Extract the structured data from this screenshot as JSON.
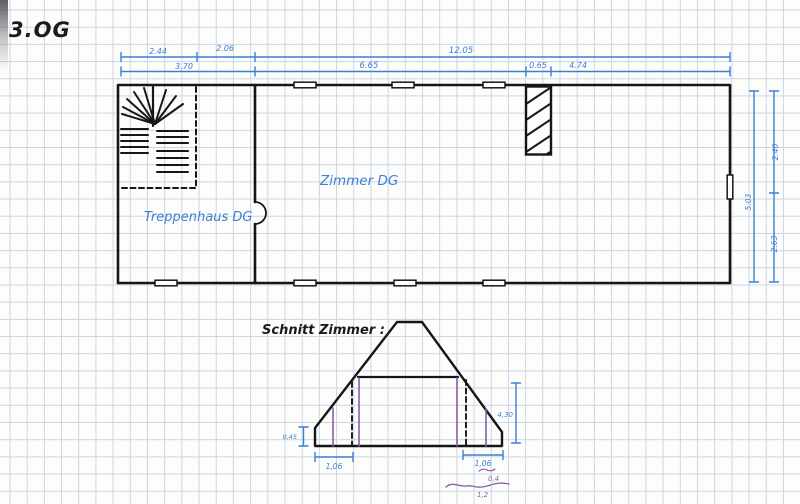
{
  "title": "3.OG",
  "plan": {
    "room_treppenhaus": "Treppenhaus DG",
    "room_zimmer": "Zimmer DG",
    "dims": {
      "row1": [
        "2.44",
        "2.06",
        "12.05"
      ],
      "row2": [
        "3.70",
        "6.65",
        "0.65",
        "4.74"
      ],
      "right_total": "5.03",
      "right_top": "2.40",
      "right_bottom": "2.63"
    }
  },
  "section": {
    "title": "Schnitt Zimmer :",
    "dim_knee": "0,45",
    "dim_bottom_left": "1,06",
    "dim_bottom_right": "1,06",
    "dim_height": "4,30",
    "note_top": "0,4",
    "note_bottom": "1,2"
  },
  "colors": {
    "ink": "#161616",
    "dimension_blue": "#3d7ed2",
    "annotation_purple": "#8a5cae",
    "grid": "#cbd5e7",
    "paper": "#fdfdfb"
  }
}
